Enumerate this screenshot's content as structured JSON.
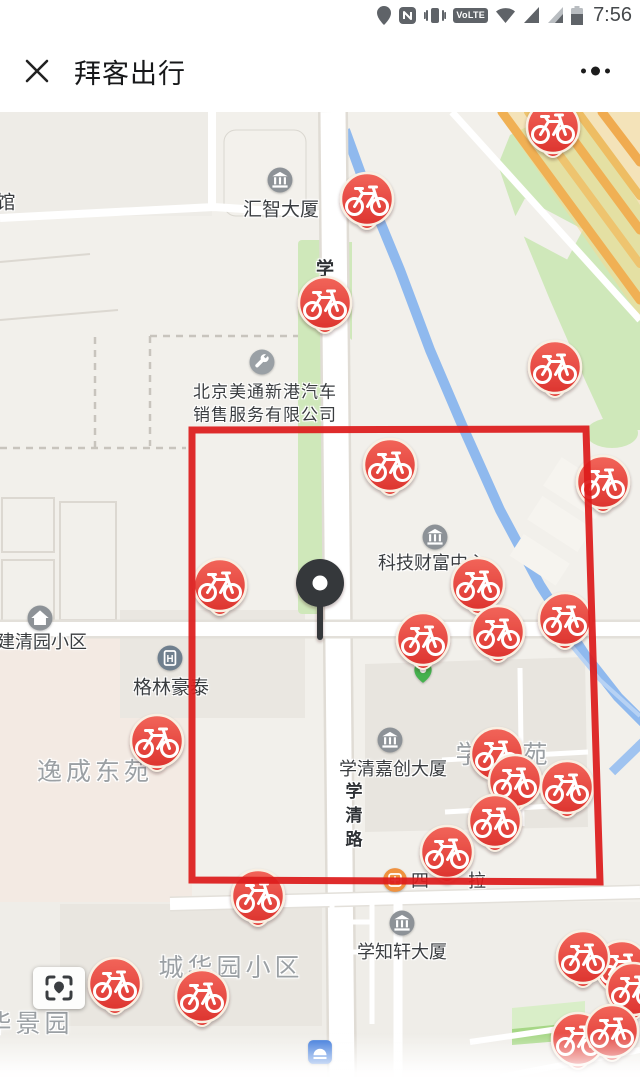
{
  "status_bar": {
    "time": "7:56",
    "volte_label": "VoLTE",
    "icons": [
      "location",
      "nfc",
      "vibrate",
      "volte",
      "wifi",
      "signal",
      "signal",
      "battery"
    ]
  },
  "header": {
    "title": "拜客出行",
    "close_label": "close",
    "more_label": "more-menu"
  },
  "map": {
    "colors": {
      "bg": "#f2f0eb",
      "green": "#cfe8ba",
      "river": "#8fb9ee",
      "highway": "#f0b054",
      "pin_red": "#e8433f",
      "annotation_red": "#dd1c1c"
    },
    "labels": [
      {
        "text": "馆",
        "x": 6,
        "y": 89,
        "cls": "poi-lg"
      },
      {
        "text": "汇智大厦",
        "x": 281,
        "y": 96,
        "cls": "poi-lg"
      },
      {
        "text": "学",
        "x": 325,
        "y": 156,
        "cls": "road"
      },
      {
        "text": "北京美通新港汽车",
        "x": 265,
        "y": 278,
        "cls": "company"
      },
      {
        "text": "销售服务有限公司",
        "x": 265,
        "y": 301,
        "cls": "company"
      },
      {
        "text": "科技财富中心",
        "x": 432,
        "y": 450,
        "cls": "poi"
      },
      {
        "text": "建清园小区",
        "x": 42,
        "y": 529,
        "cls": "poi"
      },
      {
        "text": "格林豪泰",
        "x": 171,
        "y": 574,
        "cls": "poi-lg"
      },
      {
        "text": "逸成东苑",
        "x": 95,
        "y": 658,
        "cls": "area"
      },
      {
        "text": "学清嘉创大厦",
        "x": 393,
        "y": 656,
        "cls": "poi"
      },
      {
        "text": "学清路",
        "x": 352,
        "y": 706,
        "cls": "road-v"
      },
      {
        "text": "学",
        "x": 470,
        "y": 641,
        "cls": "area"
      },
      {
        "text": "苑",
        "x": 537,
        "y": 641,
        "cls": "area"
      },
      {
        "text": "四",
        "x": 420,
        "y": 768,
        "cls": "poi"
      },
      {
        "text": "拉",
        "x": 477,
        "y": 768,
        "cls": "poi"
      },
      {
        "text": "学知轩大厦",
        "x": 402,
        "y": 839,
        "cls": "poi"
      },
      {
        "text": "城华园小区",
        "x": 231,
        "y": 854,
        "cls": "area"
      },
      {
        "text": "华景园",
        "x": 30,
        "y": 910,
        "cls": "area"
      }
    ],
    "poi_icons": [
      {
        "type": "building",
        "x": 280,
        "y": 68
      },
      {
        "type": "wrench",
        "x": 262,
        "y": 250
      },
      {
        "type": "building",
        "x": 435,
        "y": 425
      },
      {
        "type": "home",
        "x": 40,
        "y": 506
      },
      {
        "type": "hotel",
        "x": 170,
        "y": 546
      },
      {
        "type": "building",
        "x": 390,
        "y": 628
      },
      {
        "type": "green-marker",
        "x": 423,
        "y": 560
      },
      {
        "type": "orange-poi",
        "x": 395,
        "y": 768
      },
      {
        "type": "building",
        "x": 402,
        "y": 811
      },
      {
        "type": "blue-poi",
        "x": 320,
        "y": 940
      }
    ],
    "bike_pins": [
      {
        "x": 553,
        "y": 16
      },
      {
        "x": 367,
        "y": 88
      },
      {
        "x": 325,
        "y": 192
      },
      {
        "x": 555,
        "y": 256
      },
      {
        "x": 390,
        "y": 354
      },
      {
        "x": 603,
        "y": 371
      },
      {
        "x": 220,
        "y": 474
      },
      {
        "x": 478,
        "y": 473
      },
      {
        "x": 565,
        "y": 508
      },
      {
        "x": 498,
        "y": 521
      },
      {
        "x": 423,
        "y": 528
      },
      {
        "x": 157,
        "y": 630
      },
      {
        "x": 497,
        "y": 643
      },
      {
        "x": 515,
        "y": 670
      },
      {
        "x": 567,
        "y": 676
      },
      {
        "x": 495,
        "y": 710
      },
      {
        "x": 447,
        "y": 741
      },
      {
        "x": 258,
        "y": 785
      },
      {
        "x": 115,
        "y": 873
      },
      {
        "x": 202,
        "y": 885
      },
      {
        "x": 622,
        "y": 856
      },
      {
        "x": 633,
        "y": 878
      },
      {
        "x": 583,
        "y": 846
      },
      {
        "x": 578,
        "y": 928
      },
      {
        "x": 612,
        "y": 920
      }
    ],
    "center_pin": {
      "x": 320,
      "y": 471
    },
    "annotation": {
      "shape": "hand-drawn-rectangle",
      "color": "#dd1c1c",
      "points": [
        [
          192,
          318
        ],
        [
          586,
          317
        ],
        [
          600,
          770
        ],
        [
          192,
          768
        ]
      ]
    }
  }
}
